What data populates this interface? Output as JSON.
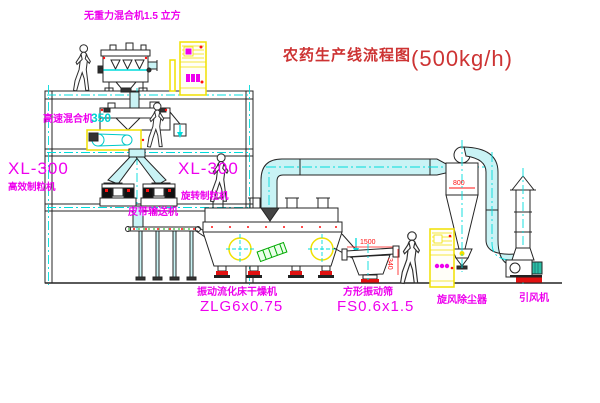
{
  "title": {
    "name": "农药生产线流程图",
    "capacity": "(500kg/h)"
  },
  "equipment_labels": {
    "gravity_free_mixer": "无重力混合机1.5 立方",
    "high_speed_mixer": "高速混合机",
    "high_speed_mixer_model": "350",
    "granulator_left_model": "XL-300",
    "granulator_left_name": "高效制粒机",
    "granulator_right_model": "XL-300",
    "granulator_right_name": "旋转制粒机",
    "belt_conveyor": "皮带输送机",
    "fluid_bed_dryer": "振动流化床干燥机",
    "fluid_bed_dryer_model": "ZLG6x0.75",
    "square_sieve": "方形振动筛",
    "square_sieve_model": "FS0.6x1.5",
    "cyclone": "旋风除尘器",
    "induced_draft_fan": "引风机"
  },
  "dimensions": {
    "sieve_length": "1500",
    "sieve_height": "340",
    "cyclone_width": "800"
  },
  "colors": {
    "label_magenta": "#ee00ee",
    "title_red": "#cd3333",
    "dimension_red": "#ff1111",
    "centerline_cyan": "#00dcdc",
    "highlight_yellow": "#f0e000",
    "line_black": "#242424",
    "duct_fill": "#c9f3f5",
    "motor_green": "#2bbfa6"
  }
}
